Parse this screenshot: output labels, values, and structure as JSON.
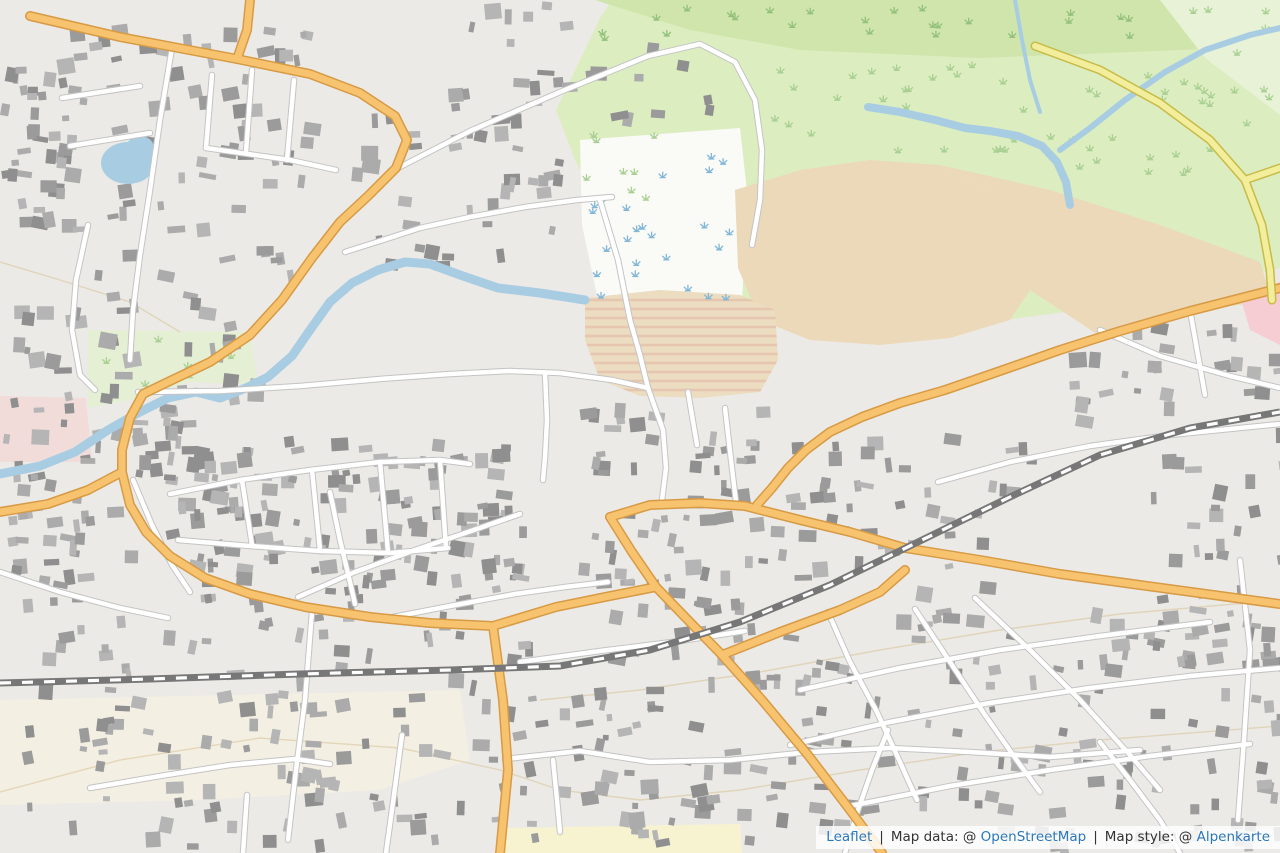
{
  "map": {
    "city_label": "Vitré",
    "colors": {
      "marker_fill": "#2b4d87",
      "marker_stroke": "#223f70",
      "marker_text": "#f3ecca",
      "marker_shadow": "#5b4a96",
      "route": "#2d4e86",
      "parking_blue": "#2e97ea",
      "water": "#a8cde3",
      "globe_green": "#8cc152",
      "globe_lines": "#f1ecca",
      "link_blue": "#2a78bd"
    },
    "markers": [
      {
        "num": "5",
        "x": 283,
        "y": 363,
        "r": 33
      },
      {
        "num": "4",
        "x": 318,
        "y": 430,
        "r": 30
      },
      {
        "num": "3",
        "x": 232,
        "y": 515,
        "r": 30
      },
      {
        "num": "2",
        "x": 368,
        "y": 486,
        "r": 30
      },
      {
        "num": "1",
        "x": 566,
        "y": 492,
        "r": 33
      },
      {
        "num": "6",
        "x": 627,
        "y": 501,
        "r": 30
      }
    ],
    "street_labels": [
      {
        "t": "Pierre Leroy",
        "x": 162,
        "y": 8,
        "r": 3
      },
      {
        "t": "Rue de Fougères",
        "x": 128,
        "y": 33,
        "r": 13
      },
      {
        "t": "Rue de Fougères",
        "x": 380,
        "y": 168,
        "r": -63
      },
      {
        "t": "Route de",
        "x": 245,
        "y": 24,
        "r": -85
      },
      {
        "t": "Chemin de Villaudin",
        "x": 500,
        "y": 110,
        "r": -23
      },
      {
        "t": "Chemin de Plaisance",
        "x": 465,
        "y": 218,
        "r": -14
      },
      {
        "t": "Rue de Balaze",
        "x": 154,
        "y": 207,
        "r": -74
      },
      {
        "t": "Rue du Rachapt",
        "x": 72,
        "y": 248,
        "r": 71
      },
      {
        "t": "Rue du Val Cantache",
        "x": 458,
        "y": 377,
        "r": -9
      },
      {
        "t": "Rue de Paris",
        "x": 690,
        "y": 501,
        "r": 3
      },
      {
        "t": "Rue de Paris",
        "x": 838,
        "y": 527,
        "r": 10
      },
      {
        "t": "Boulevard de Laval",
        "x": 1058,
        "y": 572,
        "r": 7
      },
      {
        "t": "Rue de Cohigné",
        "x": 1028,
        "y": 459,
        "r": -13
      },
      {
        "t": "Rue d'Ernée",
        "x": 1086,
        "y": 348,
        "r": -19
      },
      {
        "t": "Rue d'Ernée",
        "x": 788,
        "y": 470,
        "r": 75
      },
      {
        "t": "Boulevard du Prêche",
        "x": 772,
        "y": 601,
        "r": -26
      },
      {
        "t": "Boulevard des Jacobins",
        "x": 848,
        "y": 611,
        "r": -13
      },
      {
        "t": "Rue Neuve",
        "x": 464,
        "y": 602,
        "r": -10
      },
      {
        "t": "Rue des Fouteaux",
        "x": 650,
        "y": 647,
        "r": -8
      },
      {
        "t": "Rue de Brest",
        "x": 38,
        "y": 507,
        "r": 17
      },
      {
        "t": "Rue Rallion",
        "x": 151,
        "y": 543,
        "r": 55
      },
      {
        "t": "Bourg-aux-Moines",
        "x": 52,
        "y": 591,
        "r": 21
      },
      {
        "t": "Rue de Verdun",
        "x": 170,
        "y": 773,
        "r": 13
      },
      {
        "t": "Rue de Metz",
        "x": 243,
        "y": 841,
        "r": 82
      },
      {
        "t": "Rue de la Mériais",
        "x": 396,
        "y": 795,
        "r": -86
      },
      {
        "t": "Rue Savary",
        "x": 540,
        "y": 752,
        "r": 5
      },
      {
        "t": "Rue Savary",
        "x": 659,
        "y": 763,
        "r": 8
      },
      {
        "t": "Rue du Parc",
        "x": 556,
        "y": 792,
        "r": -85
      },
      {
        "t": "Collège",
        "x": 465,
        "y": 846,
        "r": -15
      },
      {
        "t": "Rue des Castors",
        "x": 862,
        "y": 662,
        "r": -59
      },
      {
        "t": "Rue du Bourg Joli",
        "x": 964,
        "y": 649,
        "r": 35
      },
      {
        "t": "Rue de Pré Clos",
        "x": 1022,
        "y": 630,
        "r": 34
      },
      {
        "t": "Rue Emile Ba",
        "x": 1140,
        "y": 791,
        "r": 40
      },
      {
        "t": "Garreau",
        "x": 864,
        "y": 794,
        "r": -49
      },
      {
        "t": "Rue H",
        "x": 1075,
        "y": 803,
        "r": 40
      },
      {
        "t": "Rue Garengeot",
        "x": 338,
        "y": 525,
        "r": 70
      },
      {
        "t": "Rue Sévigné",
        "x": 398,
        "y": 562,
        "r": -30
      },
      {
        "t": "Vitré",
        "x": 578,
        "y": 546,
        "r": 0,
        "type": "city",
        "s": 15
      },
      {
        "t": "la Vilaine",
        "x": 176,
        "y": 362,
        "r": 48,
        "type": "water",
        "s": 10
      },
      {
        "t": "La Vilaine",
        "x": 36,
        "y": 478,
        "r": -4,
        "type": "water",
        "s": 11
      },
      {
        "t": "La Vilaine",
        "x": 1003,
        "y": 131,
        "r": 28,
        "type": "water",
        "s": 11
      },
      {
        "t": "70",
        "x": 214,
        "y": 31,
        "r": 60,
        "type": "contour",
        "s": 10
      },
      {
        "t": "100",
        "x": 713,
        "y": 596,
        "r": -8,
        "type": "contour",
        "s": 12
      },
      {
        "t": "100",
        "x": 425,
        "y": 763,
        "r": 0,
        "type": "contour",
        "s": 12
      }
    ],
    "parking_icons": [
      [
        89,
        291
      ],
      [
        84,
        407
      ],
      [
        97,
        459
      ],
      [
        106,
        519
      ],
      [
        184,
        586
      ],
      [
        215,
        632
      ],
      [
        234,
        656
      ],
      [
        270,
        656
      ],
      [
        229,
        774
      ],
      [
        408,
        644
      ],
      [
        422,
        699
      ],
      [
        457,
        702
      ],
      [
        543,
        680
      ],
      [
        580,
        595
      ],
      [
        640,
        675
      ],
      [
        683,
        450
      ],
      [
        727,
        405
      ],
      [
        700,
        560
      ],
      [
        884,
        498
      ],
      [
        1030,
        546
      ],
      [
        1142,
        536
      ]
    ],
    "parking_icon_letter": "P",
    "pale_parking_icons": [
      [
        314,
        720
      ]
    ],
    "bus_icon": {
      "x": 386,
      "y": 661
    },
    "globe_logo": {
      "x": 85,
      "y": 792
    }
  },
  "attribution": {
    "leaflet": "Leaflet",
    "separator": "|",
    "map_data_label": "Map data: @",
    "map_data_link": "OpenStreetMap",
    "map_style_label": "Map style: @",
    "map_style_link": "Alpenkarte"
  }
}
